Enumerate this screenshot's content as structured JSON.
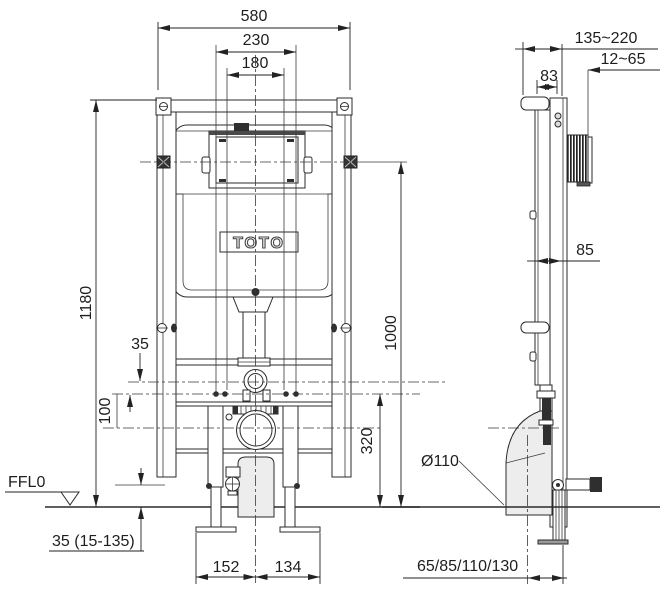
{
  "drawing": {
    "brand": "TOTO",
    "floor_label": "FFL0",
    "labels": {
      "overall_width": "580",
      "bolt_spacing": "230",
      "pipe_spacing": "180",
      "frame_height": "1180",
      "bracket_height": "1000",
      "flushpipe_offset": "35",
      "bolt_height": "100",
      "outlet_height": "320",
      "foot_left": "152",
      "foot_right": "134",
      "floor_adjust": "35 (15-135)",
      "depth_range": "135~220",
      "plate_depth": "12~65",
      "bracket_depth": "83",
      "frame_depth": "85",
      "drain_diameter": "Ø110",
      "outlet_offsets": "65/85/110/130"
    }
  }
}
